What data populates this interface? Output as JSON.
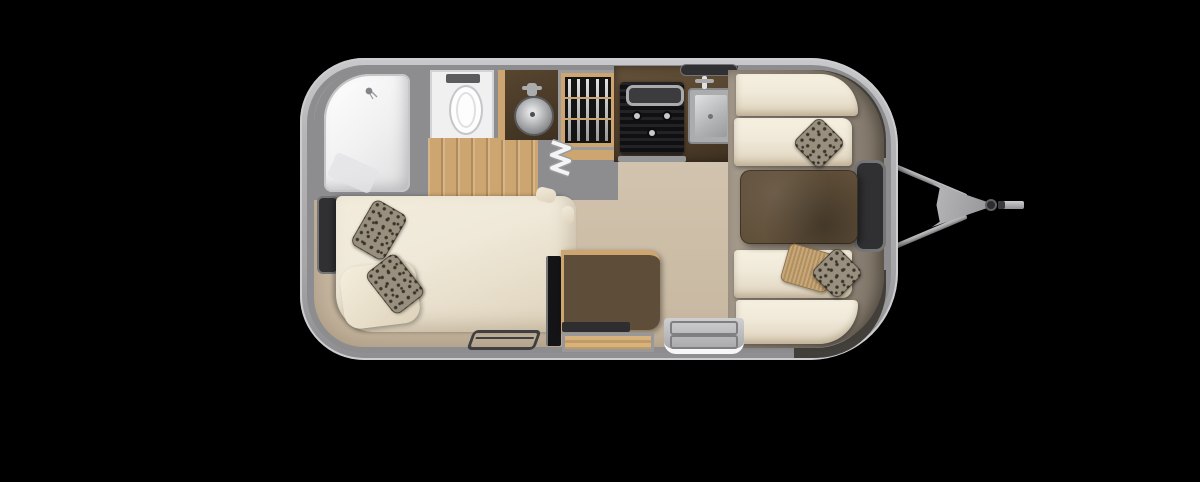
{
  "scene": {
    "description": "Top-down 3D rendered floor plan of a single-axle travel trailer, hitch pointing right",
    "background_color": "#000000"
  },
  "colors": {
    "background": "#000000",
    "shell_outer": "#b4b4b6",
    "shell_highlight": "#cdcdcf",
    "wall": "#8d8d8f",
    "floor": "#d7c9b5",
    "floor_edge": "#c7b7a0",
    "end_band_light": "#a69b8c",
    "end_band_dark": "#81776a",
    "wood": "#cda571",
    "counter": "#57452f",
    "counter_dark": "#3e3020",
    "cabinet": "#5e4d39",
    "table": "#61503a",
    "cream": "#f0e9d9",
    "cream_dark": "#ddd1ba",
    "fixture_white": "#f0f0f1",
    "fixture_trim": "#c6c6c8",
    "appliance_black": "#1a1a1c",
    "steel_light": "#e0e1e3",
    "steel": "#aaacae",
    "steel_dark": "#7e8082",
    "window": "#302f31",
    "window_trim": "#757578",
    "leopard_base": "#998f7e",
    "leopard_spot": "#3a342a",
    "burlap": "#c7a87c",
    "burlap_dark": "#b2905e",
    "hitch": "#a6a6a8",
    "hitch_dark": "#717173"
  },
  "fixtures": [
    "shower",
    "toilet",
    "bathroom-vanity-round-sink",
    "bathroom-cabinet",
    "folding-door",
    "wardrobe-with-hangers",
    "stove-cooktop",
    "kitchen-sink",
    "kitchen-counter",
    "dinette-table",
    "dinette-seat-upper",
    "dinette-seat-lower",
    "bed",
    "leopard-pillows",
    "burlap-pillow",
    "cream-pillow",
    "tv-panel",
    "credenza-cabinet",
    "drawer",
    "floor-register",
    "entry-door-step",
    "window-bedroom",
    "window-kitchen",
    "window-front",
    "wraparound-corner-windows",
    "a-frame-hitch",
    "hitch-coupler",
    "jack-handle"
  ]
}
